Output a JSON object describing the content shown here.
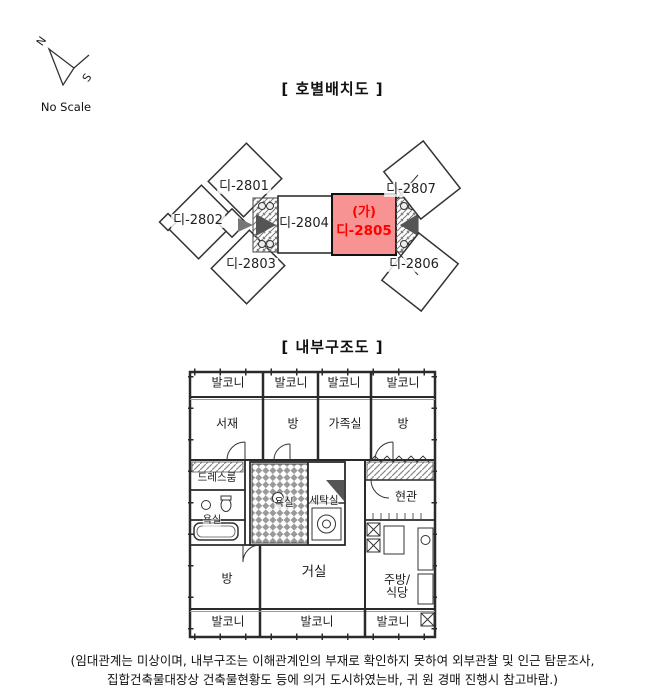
{
  "compass": {
    "north_label": "N",
    "south_label": "S",
    "scale_label": "No Scale"
  },
  "unit_layout": {
    "title": "[ 호별배치도 ]",
    "highlight_color": "#f89394",
    "highlight_text_color": "#ff0000",
    "units": [
      {
        "id": "di-2801",
        "label": "디-2801"
      },
      {
        "id": "di-2802",
        "label": "디-2802"
      },
      {
        "id": "di-2803",
        "label": "디-2803"
      },
      {
        "id": "di-2804",
        "label": "디-2804"
      },
      {
        "id": "di-2805",
        "label": "디-2805",
        "marker": "(가)",
        "highlighted": true
      },
      {
        "id": "di-2806",
        "label": "디-2806"
      },
      {
        "id": "di-2807",
        "label": "디-2807"
      }
    ]
  },
  "floor_plan": {
    "title": "[ 내부구조도 ]",
    "rooms": {
      "balcony_top": [
        "발코니",
        "발코니",
        "발코니",
        "발코니"
      ],
      "study": "서재",
      "room_top": "방",
      "family_room": "가족실",
      "room_top_right": "방",
      "dress_room": "드레스룸",
      "bath_left": "욕실",
      "bath_center": "욕실",
      "laundry": "세탁실",
      "entrance": "현관",
      "room_bottom": "방",
      "living_room": "거실",
      "kitchen_line1": "주방/",
      "kitchen_line2": "식당",
      "balcony_bottom": [
        "발코니",
        "발코니",
        "발코니"
      ]
    }
  },
  "footer": {
    "line1": "(임대관계는 미상이며,  내부구조는 이해관계인의 부재로 확인하지 못하여 외부관찰 및 인근 탐문조사,",
    "line2": "집합건축물대장상 건축물현황도 등에 의거 도시하였는바, 귀 원 경매 진행시 참고바람.)"
  }
}
